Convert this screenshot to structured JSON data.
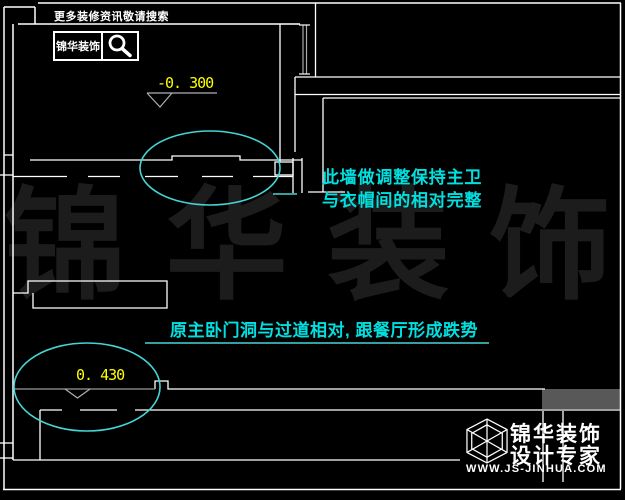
{
  "header": {
    "promo_text": "更多装修资讯敬请搜索",
    "brand_label": "锦华装饰"
  },
  "annotations": {
    "elevation_top": "-0. 300",
    "elevation_bottom": "0. 430",
    "note1_line1": "此墙做调整保持主卫",
    "note1_line2": "与衣帽间的相对完整",
    "note2": "原主卧门洞与过道相对, 跟餐厅形成跌势"
  },
  "watermark": {
    "characters": [
      "锦",
      "华",
      "装",
      "饰"
    ]
  },
  "logo": {
    "company": "锦华装饰",
    "tagline": "设计专家",
    "website": "WWW.JS-JINHUA.COM"
  },
  "colors": {
    "background": "#000000",
    "wall_line": "#ffffff",
    "dim_line": "#b0b0b0",
    "annotation_cyan": "#00e0e0",
    "ellipse_cyan": "#45d5d5",
    "elevation_yellow": "#ffff00",
    "watermark_gray": "#1c1c1c",
    "gray_block": "#585858"
  }
}
